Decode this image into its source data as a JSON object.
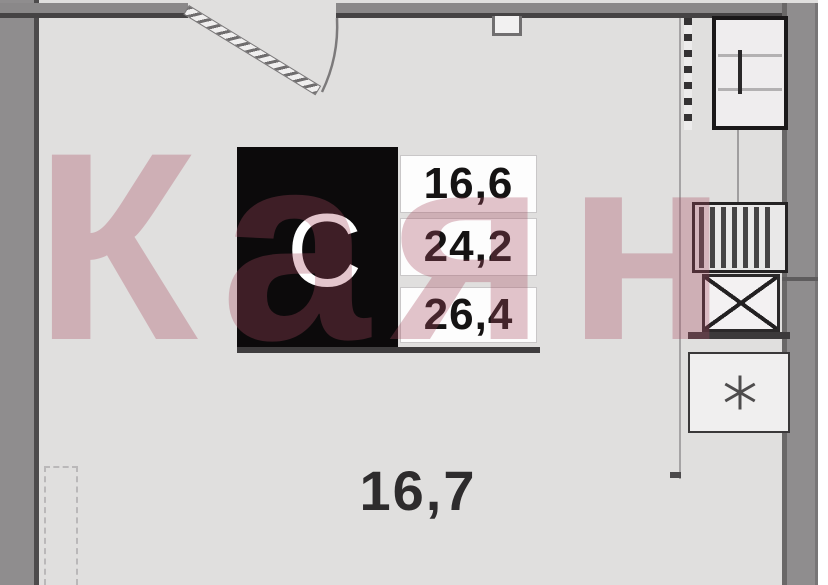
{
  "watermark": {
    "text": "Каян"
  },
  "info_card": {
    "type_label": "С",
    "values": [
      "16,6",
      "24,2",
      "26,4"
    ]
  },
  "room_label": "16,7",
  "icons": {
    "sink": "x-cross-icon",
    "fridge": "snowflake-icon",
    "door": "door-swing-arc",
    "washer": "hatched-appliance-icon"
  },
  "colors": {
    "watermark_pink": "#a84c60",
    "wall_gray": "#8f8d8e",
    "wall_dark": "#4d4b4c",
    "floor_gray": "#e0dfde",
    "card_black": "#0c0a0b",
    "text_dark": "#151313"
  }
}
